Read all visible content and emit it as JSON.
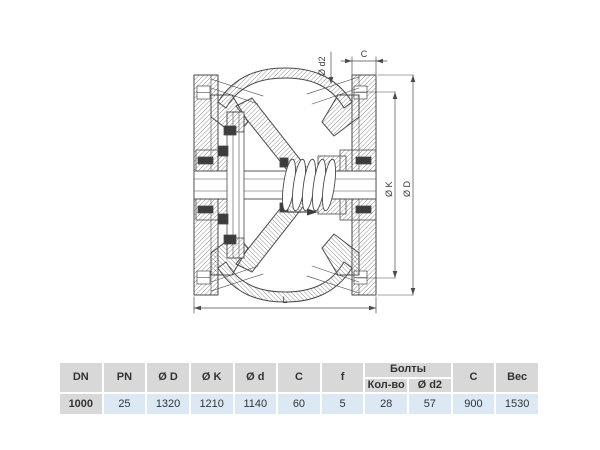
{
  "drawing": {
    "labels": {
      "c_top": "C",
      "d2": "Ø d2",
      "k": "Ø K",
      "d": "Ø D",
      "l": "L"
    }
  },
  "table": {
    "group_header": "Болты",
    "headers": {
      "dn": "DN",
      "pn": "PN",
      "d": "Ø D",
      "k": "Ø K",
      "ds": "Ø d",
      "c": "C",
      "f": "f",
      "bolts_count": "Кол-во",
      "bolts_d2": "Ø d2",
      "c2": "C",
      "weight": "Вес"
    },
    "row": {
      "dn": "1000",
      "pn": "25",
      "d": "1320",
      "k": "1210",
      "ds": "1140",
      "c": "60",
      "f": "5",
      "bolts_count": "28",
      "bolts_d2": "57",
      "c2": "900",
      "weight": "1530"
    }
  },
  "colors": {
    "header_bg": "#d8d8d8",
    "row_bg": "#dce9f5",
    "line": "#4a4a4a",
    "text": "#333333"
  }
}
